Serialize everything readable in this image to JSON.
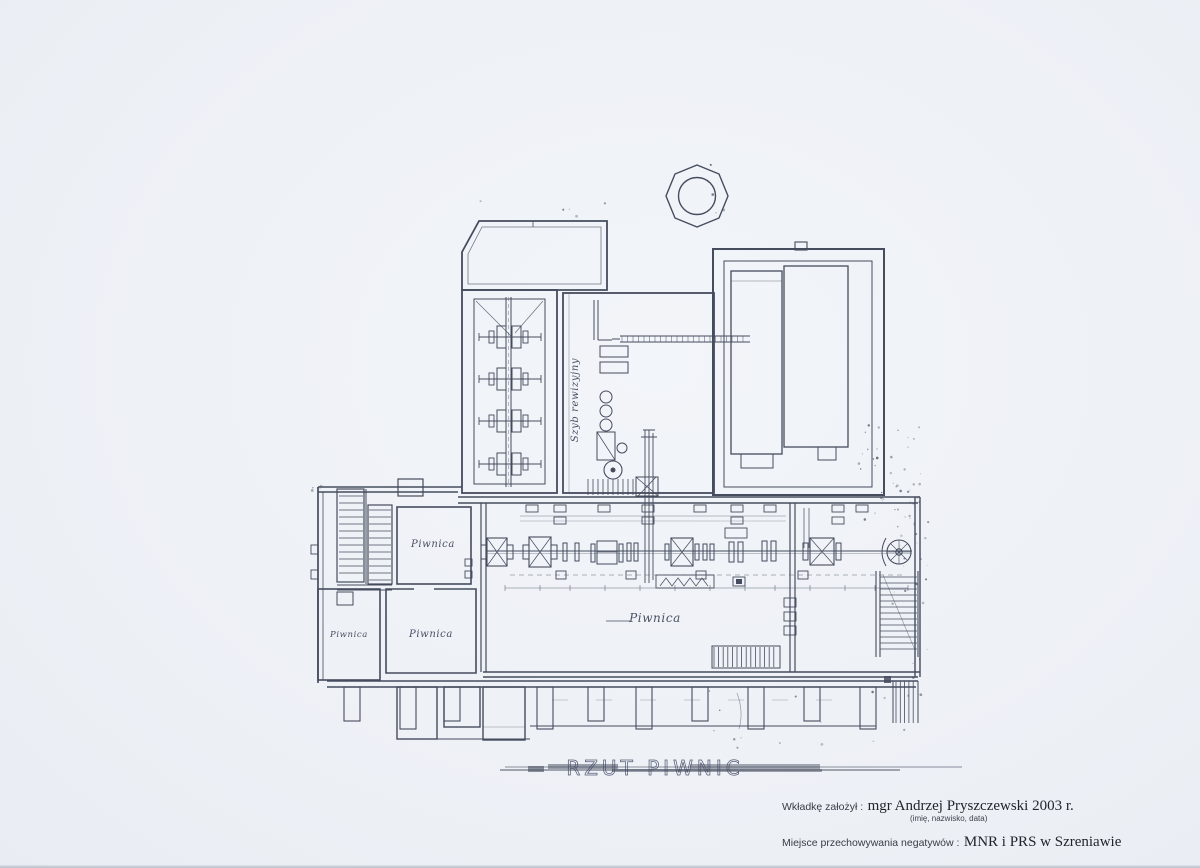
{
  "paper": {
    "background": "#eef1f6",
    "ink": "#454c5e",
    "faint_ink": "#666d82"
  },
  "plan": {
    "title": "RZUT PIWNIC",
    "labels": {
      "room_upper_left": "Piwnica",
      "room_lower_left": "Piwnica",
      "room_lower_mid": "Piwnica",
      "main_hall": "Piwnica",
      "vertical_note": "Szyb rewizyjny"
    }
  },
  "footer": {
    "inserted_by_label": "Wkładkę założył :",
    "inserted_by_value": "mgr Andrzej Pryszczewski  2003 r.",
    "inserted_by_hint": "(imię, nazwisko, data)",
    "storage_label": "Miejsce przechowywania negatywów :",
    "storage_value": "MNR i PRS w Szreniawie"
  }
}
